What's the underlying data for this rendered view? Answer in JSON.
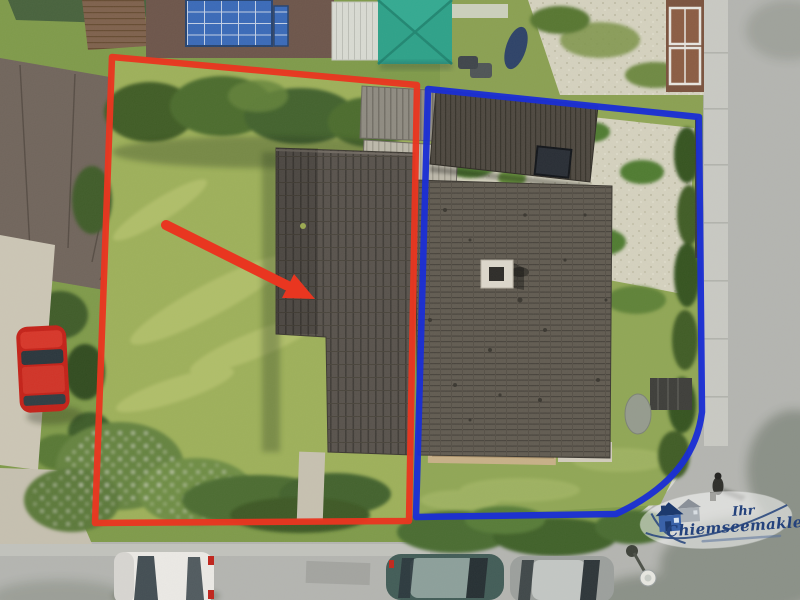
{
  "annotations": {
    "red_plot_outline": "#e93620",
    "blue_plot_outline": "#1b2fd4",
    "arrow_color": "#e93620"
  },
  "watermark": {
    "line1": "Ihr",
    "line2": "Chiemseemakler",
    "text_color": "#24427c",
    "badge_fill": "#ffffff"
  },
  "palette": {
    "lawn_base": "#7e9a48",
    "meadow": "#9db058",
    "hedge_dark": "#3c5a24",
    "road": "#b4b5b1",
    "gravel": "#d5d2bf",
    "roof_left": "#56504a",
    "roof_right": "#5f594f",
    "canopy_teal": "#2aa188",
    "solar_blue": "#3768b8",
    "car_red": "#c41e15",
    "car_white": "#eceae6",
    "car_teal": "#3f5a55",
    "car_silver": "#9b9f9c"
  }
}
